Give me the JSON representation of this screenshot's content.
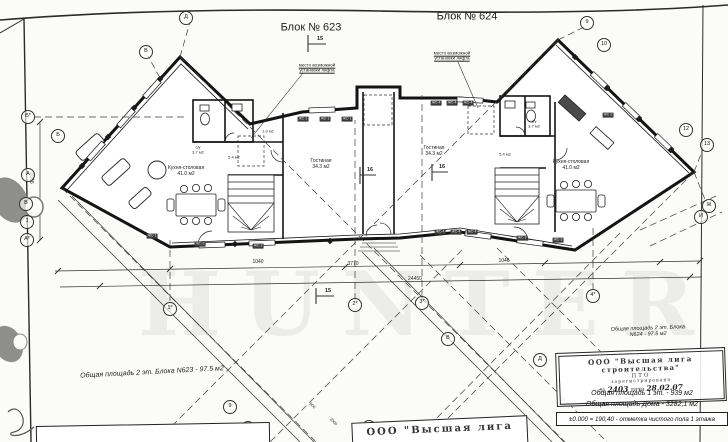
{
  "labels": [
    {
      "name": "block-623-title",
      "text": "Блок № 623",
      "x": 311,
      "y": 28,
      "fs": 11
    },
    {
      "name": "block-624-title",
      "text": "Блок № 624",
      "x": 467,
      "y": 17,
      "fs": 11
    },
    {
      "name": "lift-note-left",
      "text": "место возможной\nустановки лифта",
      "x": 317,
      "y": 68,
      "fs": 4.5,
      "u": true
    },
    {
      "name": "lift-note-right",
      "text": "место возможной\nустановки лифта",
      "x": 452,
      "y": 56,
      "fs": 4.5,
      "u": true
    },
    {
      "name": "room-kitchen-left",
      "text": "Кухня-столовая\n41.0 м2",
      "x": 186,
      "y": 172,
      "fs": 5
    },
    {
      "name": "room-kitchen-right",
      "text": "Кухня-столовая\n41.0 м2",
      "x": 571,
      "y": 166,
      "fs": 5
    },
    {
      "name": "room-living-left",
      "text": "Гостиная\n34.3 м2",
      "x": 321,
      "y": 165,
      "fs": 5
    },
    {
      "name": "room-living-right",
      "text": "Гостиная\n34.3 м2",
      "x": 434,
      "y": 152,
      "fs": 5
    },
    {
      "name": "room-wc-left",
      "text": "с/у\n3.7 м2",
      "x": 198,
      "y": 150,
      "fs": 4
    },
    {
      "name": "room-wc-right",
      "text": "с/у\n3.7 м2",
      "x": 534,
      "y": 124,
      "fs": 4
    },
    {
      "name": "room-hall-left",
      "text": "5.4 м2",
      "x": 234,
      "y": 158,
      "fs": 4
    },
    {
      "name": "room-hall-right",
      "text": "5.4 м2",
      "x": 505,
      "y": 155,
      "fs": 4
    },
    {
      "name": "room-storage-left",
      "text": "1.9 м2",
      "x": 268,
      "y": 132,
      "fs": 4
    },
    {
      "name": "dim-1040",
      "text": "1040",
      "x": 258,
      "y": 263,
      "fs": 5
    },
    {
      "name": "dim-3770",
      "text": "3770",
      "x": 353,
      "y": 265,
      "fs": 5
    },
    {
      "name": "dim-1046",
      "text": "1046",
      "x": 504,
      "y": 262,
      "fs": 5
    },
    {
      "name": "dim-24450",
      "text": "24450",
      "x": 415,
      "y": 280,
      "fs": 5
    },
    {
      "name": "dim-9000",
      "text": "9000",
      "x": 34,
      "y": 178,
      "fs": 5,
      "rot": -90
    },
    {
      "name": "dim-900",
      "text": "900",
      "x": 312,
      "y": 406,
      "fs": 4,
      "rot": 45
    },
    {
      "name": "dim-2000",
      "text": "2000",
      "x": 333,
      "y": 422,
      "fs": 4,
      "rot": 45
    },
    {
      "name": "section-15-top",
      "text": "15",
      "x": 320,
      "y": 39,
      "fs": 5.5,
      "bold": true
    },
    {
      "name": "section-15-bottom",
      "text": "15",
      "x": 328,
      "y": 291,
      "fs": 5.5,
      "bold": true
    },
    {
      "name": "section-16-left",
      "text": "16",
      "x": 370,
      "y": 170,
      "fs": 5.5,
      "bold": true
    },
    {
      "name": "section-16-right",
      "text": "16",
      "x": 442,
      "y": 167,
      "fs": 5.5,
      "bold": true
    },
    {
      "name": "area-note-623",
      "text": "Общая площадь 2 эт. Блока N623 - 97.5 м2",
      "x": 152,
      "y": 373,
      "fs": 7,
      "rot": -3,
      "italic": true
    },
    {
      "name": "area-note-624",
      "text": "Общая площадь 2 эт. Блока N624 - 97.5 м2",
      "x": 648,
      "y": 332,
      "fs": 5.5,
      "rot": -2,
      "italic": true
    }
  ],
  "axis_markers": [
    {
      "t": "Д",
      "x": 186,
      "y": 18
    },
    {
      "t": "В",
      "x": 146,
      "y": 52
    },
    {
      "t": "Б*",
      "x": 28,
      "y": 117
    },
    {
      "t": "Б",
      "x": 58,
      "y": 136
    },
    {
      "t": "А",
      "x": 28,
      "y": 175
    },
    {
      "t": "В",
      "x": 26,
      "y": 204
    },
    {
      "t": "1",
      "x": 27,
      "y": 222
    },
    {
      "t": "А*",
      "x": 27,
      "y": 240
    },
    {
      "t": "1*",
      "x": 170,
      "y": 309
    },
    {
      "t": "2*",
      "x": 355,
      "y": 305
    },
    {
      "t": "3*",
      "x": 422,
      "y": 303
    },
    {
      "t": "4*",
      "x": 593,
      "y": 296
    },
    {
      "t": "9",
      "x": 230,
      "y": 407
    },
    {
      "t": "10",
      "x": 248,
      "y": 428
    },
    {
      "t": "5",
      "x": 369,
      "y": 427
    },
    {
      "t": "В",
      "x": 448,
      "y": 339
    },
    {
      "t": "Д",
      "x": 540,
      "y": 360
    },
    {
      "t": "9",
      "x": 587,
      "y": 23
    },
    {
      "t": "10",
      "x": 604,
      "y": 45
    },
    {
      "t": "12",
      "x": 686,
      "y": 130
    },
    {
      "t": "13",
      "x": 707,
      "y": 145
    },
    {
      "t": "Ж",
      "x": 709,
      "y": 206
    },
    {
      "t": "И",
      "x": 701,
      "y": 217
    }
  ],
  "wall_tags": [
    {
      "t": "ЖС-1",
      "x": 303,
      "y": 119
    },
    {
      "t": "ЖС-1",
      "x": 325,
      "y": 119
    },
    {
      "t": "ЖС-1",
      "x": 347,
      "y": 119
    },
    {
      "t": "ЖС-4",
      "x": 436,
      "y": 103
    },
    {
      "t": "ЖС-4",
      "x": 452,
      "y": 103
    },
    {
      "t": "ЖС-4",
      "x": 468,
      "y": 103
    },
    {
      "t": "ЖС-2",
      "x": 200,
      "y": 244
    },
    {
      "t": "ЖС-2",
      "x": 258,
      "y": 246
    },
    {
      "t": "ЖС-4",
      "x": 440,
      "y": 232
    },
    {
      "t": "ЖС-4",
      "x": 456,
      "y": 232
    },
    {
      "t": "ЖС-4",
      "x": 472,
      "y": 232
    },
    {
      "t": "ЖС-3",
      "x": 522,
      "y": 238
    },
    {
      "t": "ЖС-3",
      "x": 558,
      "y": 240
    },
    {
      "t": "ЖС-2",
      "x": 608,
      "y": 115
    },
    {
      "t": "ЖС-1",
      "x": 152,
      "y": 236
    }
  ],
  "stamp": {
    "org_line1": "ООО \"Высшая лига",
    "org_line2": "строительства\"",
    "dept": "ПТО",
    "registered": "зарегистрировано",
    "number_label": "№",
    "number_value": "2403",
    "date_label": "дата",
    "date_value": "28.02.07"
  },
  "summary": {
    "floor_area": "Общая площадь 1 эт. - 939 м2",
    "house_area": "Общая площадь Дома - 3282,1 м2",
    "elevation": "±0.000 = 190,40 - отметка чистого пола 1 этажа"
  },
  "bottom_stamp": {
    "org": "ООО \"Высшая лига"
  },
  "watermark": {
    "line1": "HOME",
    "line2": "HUNTER"
  }
}
